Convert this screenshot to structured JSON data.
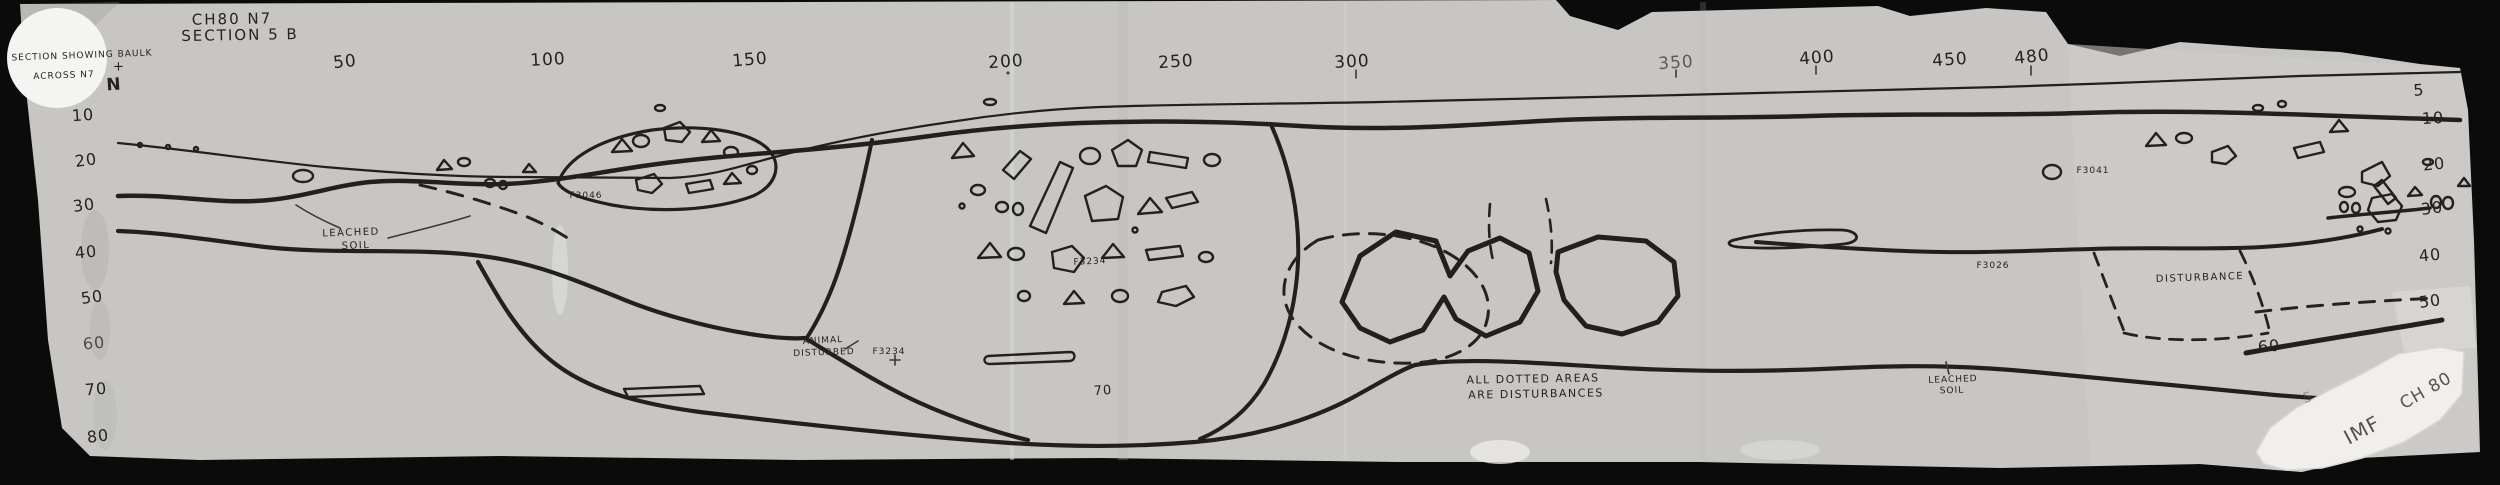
{
  "header": {
    "site_code": "CH80  N7",
    "section_label": "SECTION 5 B",
    "caption_line1": "SECTION SHOWING BAULK",
    "caption_line2": "ACROSS N7",
    "north_mark": "+",
    "north_letter": "N"
  },
  "scales": {
    "top": [
      "50",
      "100",
      "150",
      "200",
      "250",
      "300",
      "350",
      "400",
      "450",
      "480"
    ],
    "left": [
      "10",
      "20",
      "30",
      "40",
      "50",
      "60",
      "70",
      "80"
    ],
    "right": [
      "5",
      "10",
      "20",
      "30",
      "40",
      "50",
      "60"
    ]
  },
  "annotations": {
    "leached_left_1": "LEACHED",
    "leached_left_2": "SOIL",
    "f3046": "F3046",
    "animal_1": "ANIMAL",
    "animal_2": "DISTURBED",
    "f3234_a": "F3234",
    "f3234_b": "F3234",
    "depth_70": "70",
    "dotted_note_1": "ALL DOTTED AREAS",
    "dotted_note_2": "ARE DISTURBANCES",
    "leached_right_1": "LEACHED",
    "leached_right_2": "SOIL",
    "f3026": "F3026",
    "disturbance": "DISTURBANCE",
    "f3041": "F3041"
  },
  "label_patch": {
    "code": "CH 80",
    "initials": "IMF",
    "scribble": "5"
  },
  "colors": {
    "ink": "#221f1c",
    "paper": "#c7c6c2",
    "background": "#0b0b0b"
  }
}
